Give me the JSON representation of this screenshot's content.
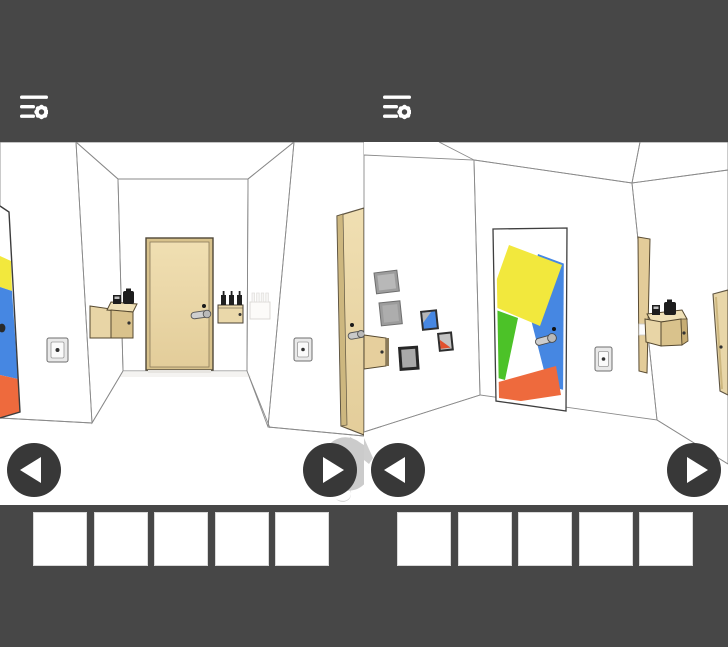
{
  "window": {
    "width": 728,
    "height": 647,
    "description": "two side-by-side escape-game screenshots"
  },
  "colors": {
    "chrome_bg": "#474747",
    "nav_button_bg": "#383838",
    "nav_arrow": "#ffffff",
    "slot_bg": "#ffffff",
    "wall_white": "#fcfcfb",
    "wall_shade": "#f7f5f1",
    "ceiling_edge": "#e7e6e3",
    "door_beige": "#ecd9ab",
    "door_beige_dark": "#e3cd9a",
    "door_frame_wood": "#cdb77f",
    "wood_front": "#d9c28c",
    "wood_top": "#efe0b6",
    "wood_panel": "#e8d5a6",
    "art_yellow": "#f2e83d",
    "art_green": "#4cc228",
    "art_blue": "#4687e2",
    "art_orange": "#ee6a3d",
    "frame_gray": "#9c9c9c",
    "frame_dark": "#2e2e2e",
    "frame_fill": "#b8b8b8",
    "picture_red": "#e2512e",
    "hint_gray": "#cbcbcb",
    "metal": "#cdcdcd",
    "item_dark": "#1d1d1d"
  },
  "top_bar": {
    "menu_icon": "menu-settings-icon"
  },
  "panels": [
    {
      "id": "left-view",
      "scene_name": "hallway-with-beige-door",
      "objects": [
        "painted-door-edge",
        "light-switch-left",
        "wall-cabinet-with-items",
        "beige-door-center",
        "door-lever-handle",
        "keyhole",
        "dispenser-box-with-bottles",
        "wall-dispenser-far",
        "light-switch-right",
        "beige-door-right",
        "tap-hint-blob"
      ],
      "nav": {
        "prev": "left-arrow-button",
        "next": "right-arrow-button"
      },
      "inventory_slots": 5
    },
    {
      "id": "right-view",
      "scene_name": "corner-with-painted-door",
      "objects": [
        "picture-frame-gray-1",
        "picture-frame-gray-2",
        "picture-frame-blue",
        "picture-frame-red-triangle",
        "picture-frame-dark",
        "wall-cabinet-open",
        "painted-door",
        "door-lever-handle",
        "keyhole",
        "light-switch",
        "open-cabinet-door-panel",
        "shelf-box-with-items",
        "beige-door-far-right"
      ],
      "nav": {
        "prev": "left-arrow-button",
        "next": "right-arrow-button"
      },
      "inventory_slots": 5
    }
  ],
  "inventory": {
    "slots_per_panel": 5,
    "total_slots": 10,
    "all_empty": true
  }
}
